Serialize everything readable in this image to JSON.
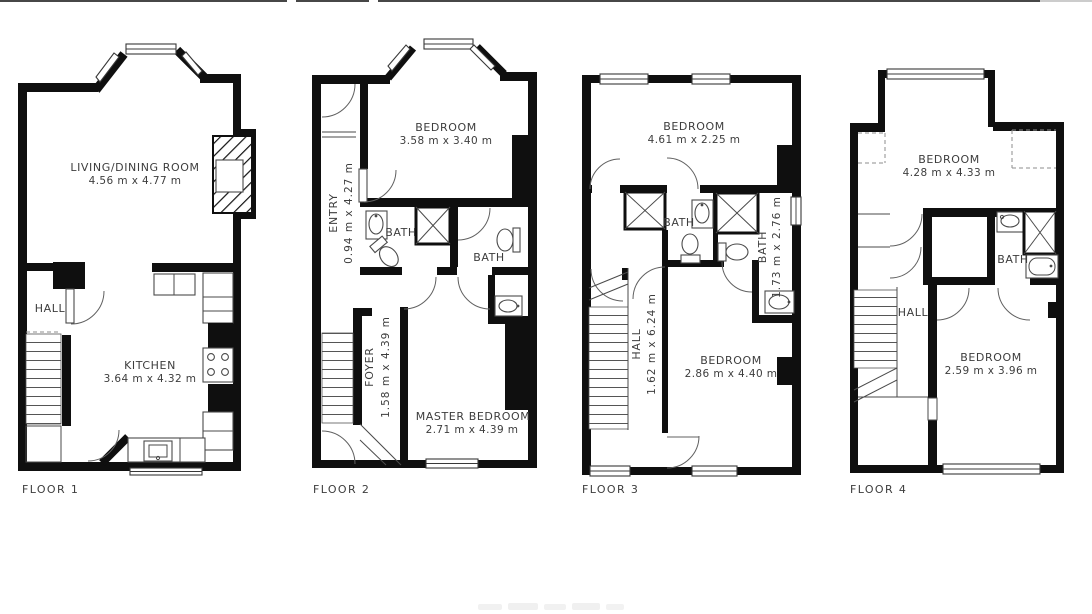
{
  "colors": {
    "wall": "#0f0f0f",
    "line": "#4a4a4a",
    "text": "#3d3d3d",
    "background": "#ffffff"
  },
  "floors": [
    {
      "label": "FLOOR 1",
      "rooms": [
        {
          "name": "LIVING/DINING ROOM",
          "dims": "4.56 m x 4.77 m"
        },
        {
          "name": "HALL"
        },
        {
          "name": "KITCHEN",
          "dims": "3.64 m x 4.32 m"
        }
      ]
    },
    {
      "label": "FLOOR 2",
      "rooms": [
        {
          "name": "BEDROOM",
          "dims": "3.58 m x 3.40 m"
        },
        {
          "name": "ENTRY",
          "dims": "0.94 m x 4.27 m"
        },
        {
          "name": "BATH"
        },
        {
          "name": "BATH"
        },
        {
          "name": "FOYER",
          "dims": "1.58 m x 4.39 m"
        },
        {
          "name": "MASTER BEDROOM",
          "dims": "2.71 m x 4.39 m"
        }
      ]
    },
    {
      "label": "FLOOR 3",
      "rooms": [
        {
          "name": "BEDROOM",
          "dims": "4.61 m x 2.25 m"
        },
        {
          "name": "BATH"
        },
        {
          "name": "BATH",
          "dims": "1.73 m x 2.76 m"
        },
        {
          "name": "HALL",
          "dims": "1.62 m x 6.24 m"
        },
        {
          "name": "BEDROOM",
          "dims": "2.86 m x 4.40 m"
        }
      ]
    },
    {
      "label": "FLOOR 4",
      "rooms": [
        {
          "name": "BEDROOM",
          "dims": "4.28 m x 4.33 m"
        },
        {
          "name": "BATH"
        },
        {
          "name": "HALL"
        },
        {
          "name": "BEDROOM",
          "dims": "2.59 m x 3.96 m"
        }
      ]
    }
  ]
}
